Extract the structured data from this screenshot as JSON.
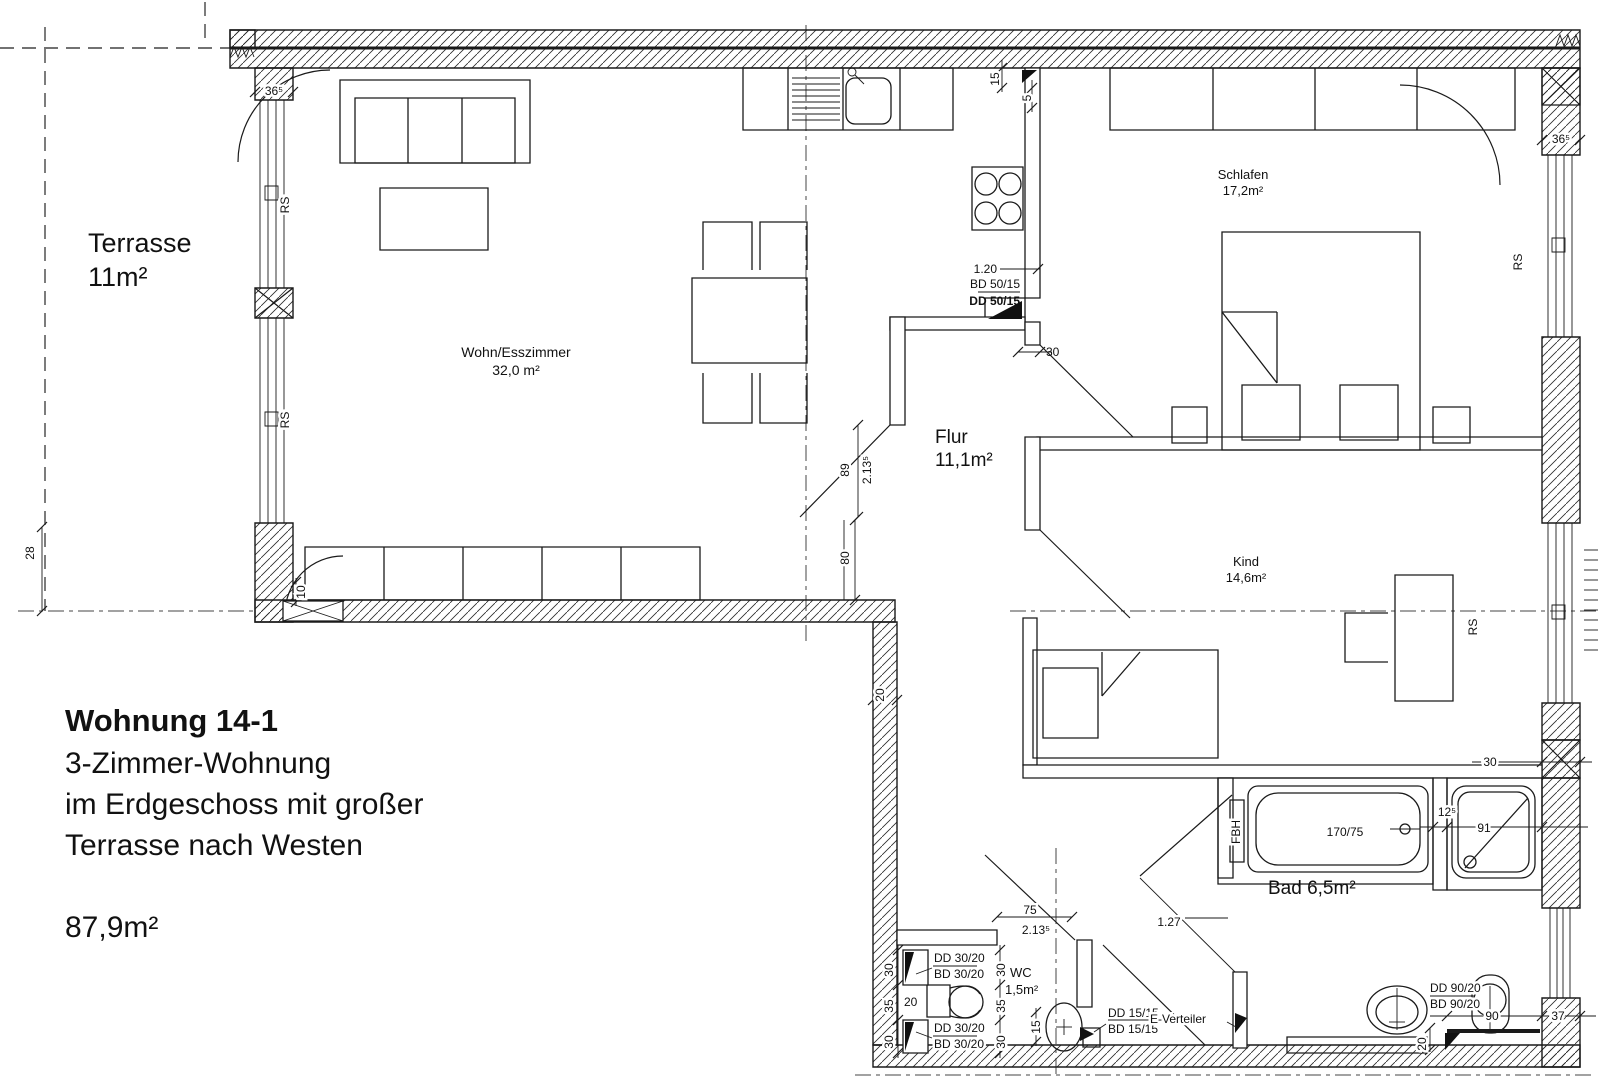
{
  "title_block": {
    "line1": "Wohnung 14-1",
    "line2": "3-Zimmer-Wohnung",
    "line3": "im Erdgeschoss mit großer",
    "line4": "Terrasse nach Westen",
    "area": "87,9m²"
  },
  "rooms": {
    "terrasse_name": "Terrasse",
    "terrasse_area": "11m²",
    "wohn_name": "Wohn/Esszimmer",
    "wohn_area": "32,0 m²",
    "schlafen_name": "Schlafen",
    "schlafen_area": "17,2m²",
    "flur_name": "Flur",
    "flur_area": "11,1m²",
    "kind_name": "Kind",
    "kind_area": "14,6m²",
    "bad_label": "Bad 6,5m²",
    "wc_name": "WC",
    "wc_area": "1,5m²"
  },
  "dims": {
    "d365": "36⁵",
    "rs": "RS",
    "d28": "28",
    "d10": "10",
    "d80": "80",
    "d20": "20",
    "d89": "89",
    "d2135": "2.13⁵",
    "d15": "15",
    "d5": "5",
    "d120": "1.20",
    "d30": "30",
    "d35": "35",
    "d75": "75",
    "d127": "1.27",
    "d125": "12⁵",
    "d91": "91",
    "d90": "90",
    "d37": "37",
    "bd5015": "BD 50/15",
    "dd5015": "DD 50/15",
    "dd3020": "DD 30/20",
    "bd3020": "BD 30/20",
    "dd1515": "DD 15/15",
    "bd1515": "BD 15/15",
    "dd9020": "DD 90/20",
    "bd9020": "BD 90/20",
    "tub": "170/75",
    "fbh": "FBH",
    "everteiler": "E-Verteiler"
  }
}
